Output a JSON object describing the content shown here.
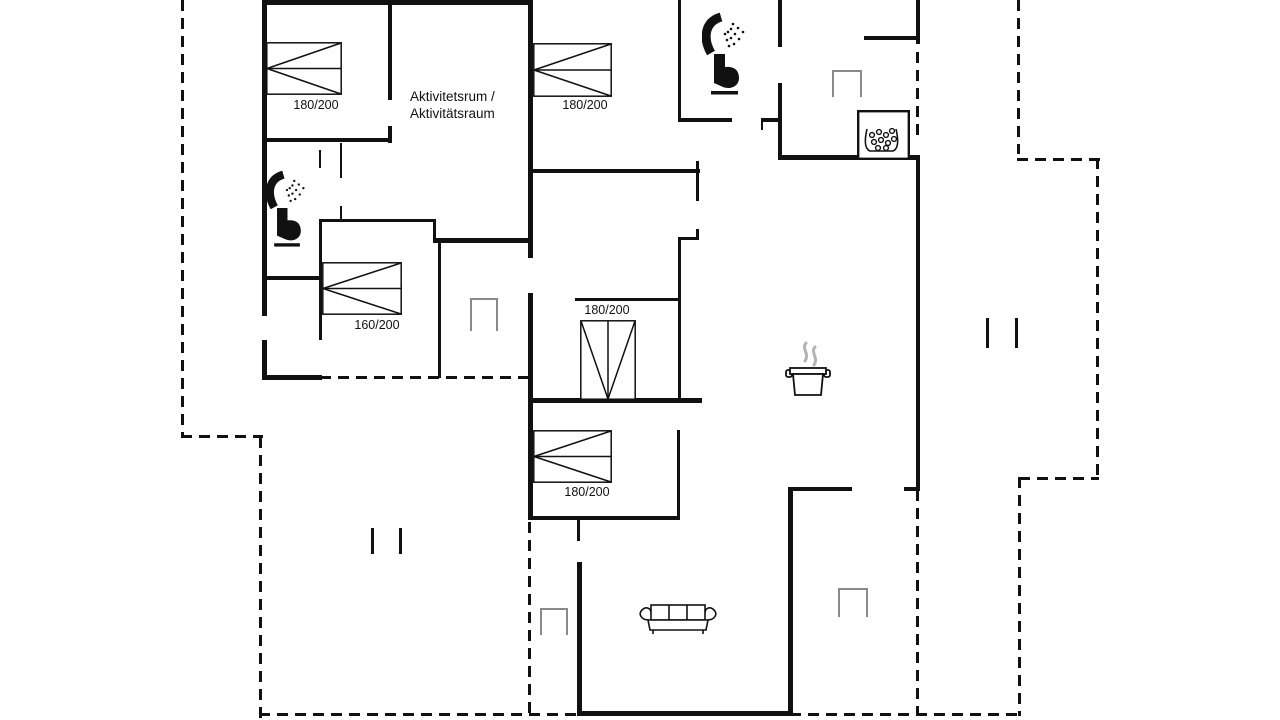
{
  "plan": {
    "width": 1280,
    "height": 720,
    "background": "#ffffff",
    "line_color": "#111111",
    "marker_color": "#8a8a8a",
    "steam_color": "#b3b3b3",
    "dash_len": 11,
    "dash_gap": 7,
    "dash_thickness": 3,
    "labels": {
      "activity_room_line1": "Aktivitetsrum /",
      "activity_room_line2": "Aktivitätsraum"
    },
    "walls": [
      [
        262,
        0,
        271,
        5
      ],
      [
        262,
        0,
        5,
        316
      ],
      [
        262,
        340,
        5,
        40
      ],
      [
        262,
        375,
        60,
        5
      ],
      [
        388,
        0,
        4,
        100
      ],
      [
        388,
        126,
        4,
        17
      ],
      [
        262,
        138,
        130,
        4
      ],
      [
        340,
        143,
        2,
        35
      ],
      [
        340,
        206,
        2,
        15
      ],
      [
        319,
        150,
        2,
        18
      ],
      [
        262,
        276,
        60,
        4
      ],
      [
        319,
        219,
        3,
        121
      ],
      [
        320,
        219,
        116,
        3
      ],
      [
        433,
        219,
        3,
        23
      ],
      [
        433,
        238,
        100,
        5
      ],
      [
        438,
        240,
        3,
        138
      ],
      [
        528,
        0,
        5,
        258
      ],
      [
        528,
        293,
        5,
        227
      ],
      [
        530,
        169,
        170,
        4
      ],
      [
        696,
        161,
        3,
        40
      ],
      [
        696,
        229,
        3,
        11
      ],
      [
        678,
        237,
        21,
        3
      ],
      [
        678,
        237,
        3,
        165
      ],
      [
        575,
        298,
        105,
        3
      ],
      [
        529,
        398,
        173,
        5
      ],
      [
        677,
        430,
        3,
        90
      ],
      [
        529,
        516,
        151,
        4
      ],
      [
        577,
        516,
        3,
        25
      ],
      [
        577,
        562,
        5,
        154
      ],
      [
        577,
        711,
        216,
        5
      ],
      [
        788,
        487,
        5,
        229
      ],
      [
        788,
        487,
        64,
        4
      ],
      [
        904,
        487,
        16,
        4
      ],
      [
        916,
        0,
        4,
        44
      ],
      [
        916,
        157,
        4,
        333
      ],
      [
        778,
        155,
        142,
        5
      ],
      [
        778,
        0,
        4,
        47
      ],
      [
        778,
        83,
        4,
        74
      ],
      [
        678,
        118,
        54,
        4
      ],
      [
        761,
        118,
        19,
        4
      ],
      [
        678,
        0,
        3,
        122
      ],
      [
        864,
        36,
        54,
        4
      ],
      [
        761,
        118,
        2,
        12
      ]
    ],
    "dashed": [
      {
        "dir": "v",
        "x": 181,
        "y": 0,
        "len": 437
      },
      {
        "dir": "h",
        "x": 181,
        "y": 435,
        "len": 82
      },
      {
        "dir": "v",
        "x": 259,
        "y": 437,
        "len": 281
      },
      {
        "dir": "h",
        "x": 259,
        "y": 713,
        "len": 323
      },
      {
        "dir": "v",
        "x": 528,
        "y": 522,
        "len": 194
      },
      {
        "dir": "h",
        "x": 790,
        "y": 713,
        "len": 230
      },
      {
        "dir": "v",
        "x": 916,
        "y": 490,
        "len": 226
      },
      {
        "dir": "v",
        "x": 916,
        "y": 52,
        "len": 85
      },
      {
        "dir": "v",
        "x": 1017,
        "y": 0,
        "len": 154
      },
      {
        "dir": "h",
        "x": 1017,
        "y": 158,
        "len": 83
      },
      {
        "dir": "v",
        "x": 1096,
        "y": 158,
        "len": 322
      },
      {
        "dir": "h",
        "x": 1019,
        "y": 477,
        "len": 80
      },
      {
        "dir": "v",
        "x": 1018,
        "y": 477,
        "len": 239
      },
      {
        "dir": "h",
        "x": 320,
        "y": 376,
        "len": 210
      }
    ],
    "window_markers": [
      {
        "x": 470,
        "y": 298,
        "w": 28,
        "h": 33
      },
      {
        "x": 832,
        "y": 70,
        "w": 30,
        "h": 27
      },
      {
        "x": 540,
        "y": 608,
        "w": 28,
        "h": 27
      },
      {
        "x": 838,
        "y": 588,
        "w": 30,
        "h": 29
      }
    ],
    "boundary_ticks": [
      {
        "x": 371,
        "y": 528,
        "len": 26
      },
      {
        "x": 399,
        "y": 528,
        "len": 26
      },
      {
        "x": 986,
        "y": 318,
        "len": 30
      },
      {
        "x": 1015,
        "y": 318,
        "len": 30
      }
    ],
    "beds": [
      {
        "name": "double-bed",
        "x": 266,
        "y": 42,
        "w": 76,
        "h": 53,
        "dir": "left",
        "label": "180/200",
        "lx": 316,
        "ly": 105
      },
      {
        "name": "double-bed",
        "x": 533,
        "y": 43,
        "w": 79,
        "h": 54,
        "dir": "left",
        "label": "180/200",
        "lx": 585,
        "ly": 105
      },
      {
        "name": "double-bed",
        "x": 322,
        "y": 262,
        "w": 80,
        "h": 53,
        "dir": "left",
        "label": "160/200",
        "lx": 377,
        "ly": 325
      },
      {
        "name": "double-bed",
        "x": 580,
        "y": 320,
        "w": 56,
        "h": 80,
        "dir": "down",
        "label": "180/200",
        "lx": 607,
        "ly": 310
      },
      {
        "name": "double-bed",
        "x": 533,
        "y": 430,
        "w": 79,
        "h": 53,
        "dir": "left",
        "label": "180/200",
        "lx": 587,
        "ly": 492
      }
    ],
    "icons": [
      {
        "name": "shower-icon",
        "x": 266,
        "y": 170,
        "w": 42,
        "h": 40
      },
      {
        "name": "toilet-icon",
        "x": 271,
        "y": 208,
        "w": 33,
        "h": 40
      },
      {
        "name": "shower-icon",
        "x": 702,
        "y": 12,
        "w": 46,
        "h": 44
      },
      {
        "name": "toilet-icon",
        "x": 708,
        "y": 54,
        "w": 34,
        "h": 42
      },
      {
        "name": "sofa-icon",
        "x": 637,
        "y": 602,
        "w": 82,
        "h": 36
      },
      {
        "name": "cooking-pot-icon",
        "x": 785,
        "y": 340,
        "w": 46,
        "h": 58
      },
      {
        "name": "stove-icon",
        "x": 857,
        "y": 110,
        "w": 53,
        "h": 50
      }
    ]
  }
}
